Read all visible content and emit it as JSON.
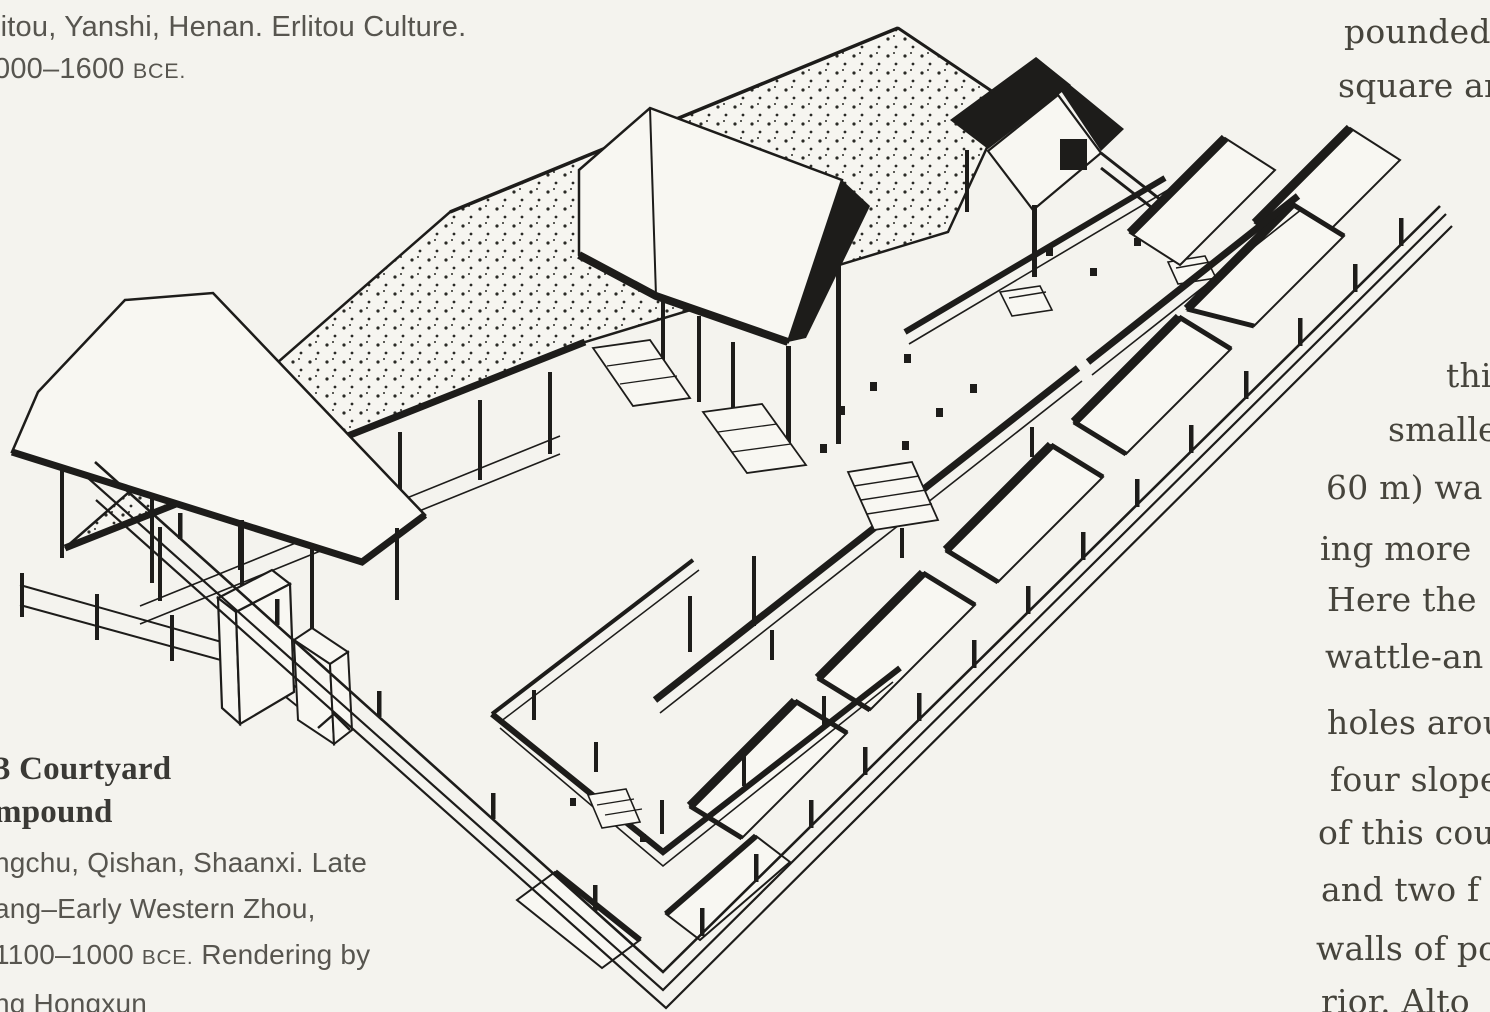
{
  "page": {
    "background": "#f4f3ee",
    "ink": "#1d1c1a"
  },
  "captions": {
    "top": {
      "line1": "litou, Yanshi, Henan. Erlitou Culture.",
      "line2_date": "000–1600",
      "line2_era": "BCE."
    },
    "bottom": {
      "heading_line1": "3 Courtyard",
      "heading_line2": "mpound",
      "line1": "ngchu, Qishan, Shaanxi. Late",
      "line2": "ang–Early Western Zhou,",
      "line3_date": "1100–1000",
      "line3_era": "BCE.",
      "line3_rest": "Rendering by",
      "line4": "ng Hongxun"
    }
  },
  "right_column": {
    "fragments": [
      {
        "text": "pounded",
        "x": 1344,
        "y": 12
      },
      {
        "text": "square an",
        "x": 1338,
        "y": 66
      },
      {
        "text": "this",
        "x": 1446,
        "y": 356
      },
      {
        "text": "smalle",
        "x": 1388,
        "y": 410
      },
      {
        "text": "60 m) wa",
        "x": 1326,
        "y": 468
      },
      {
        "text": "ing more",
        "x": 1320,
        "y": 529
      },
      {
        "text": "Here the",
        "x": 1327,
        "y": 580
      },
      {
        "text": "wattle-an",
        "x": 1325,
        "y": 637
      },
      {
        "text": "holes arou",
        "x": 1327,
        "y": 703
      },
      {
        "text": "four slope",
        "x": 1330,
        "y": 760
      },
      {
        "text": "of this cou",
        "x": 1318,
        "y": 813
      },
      {
        "text": "and two f",
        "x": 1321,
        "y": 870
      },
      {
        "text": "walls of po",
        "x": 1316,
        "y": 929
      },
      {
        "text": "rior. Alto",
        "x": 1321,
        "y": 982
      }
    ]
  },
  "illustration": {
    "description": "Isometric ink rendering of a walled courtyard compound: stippled rear hall roof, central gabled hall, rear gate tower, side chambers along terraced walls with fence posts, stairs, ramps, column bases, and a freestanding screen wall at the entrance"
  }
}
